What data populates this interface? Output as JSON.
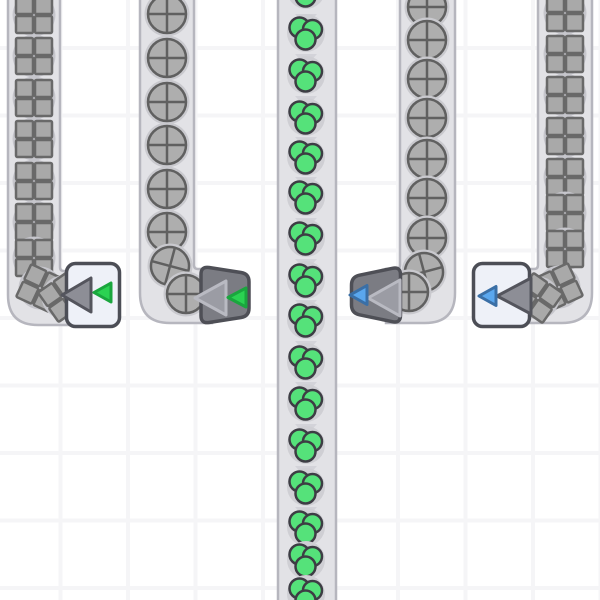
{
  "canvas": {
    "width": 600,
    "height": 600
  },
  "scene": {
    "background": "#ffffff",
    "grid": {
      "size": 67.5,
      "line_width": 4,
      "offset_x": 58.5,
      "offset_y": 46,
      "line_color": "#f5f5f7"
    },
    "belt": {
      "fill": "#e2e2e6",
      "stroke": "#b6b6be",
      "stroke_width": 2.5,
      "chevron_color": "#d3d3d9"
    },
    "items": {
      "square": {
        "fill": "#a9a9a9",
        "stroke": "#696969",
        "halo": "#c6c6cc"
      },
      "circle": {
        "fill": "#aeaeae",
        "stroke": "#606060",
        "halo": "#c9c9ce"
      },
      "berries": {
        "fill": "#55e27a",
        "stroke": "#3d3d44",
        "halo": "#cfcfd4"
      }
    },
    "buildings": {
      "light_body": "#eef1f8",
      "light_border": "#4c4e56",
      "dark_body": "#7b7c83",
      "dark_border": "#4e4f56",
      "arrow_on_light": {
        "fill": "#8d8e96",
        "stroke": "#54555d"
      },
      "arrow_on_dark": {
        "fill": "#9b9ca4",
        "stroke": "#b9bac2"
      },
      "green": {
        "fill": "#2bd252",
        "stroke": "#1aa63e"
      },
      "blue": {
        "fill": "#5aa7ee",
        "stroke": "#3a6fa6"
      }
    }
  },
  "belts": [
    {
      "id": "a",
      "item": "square",
      "cx": 34,
      "track": "M8,-10 L8,295 Q8,325 38,325 L84,325 L84,271 L64,271 Q60,271 60,267 L60,-10 Z",
      "chevrons": [
        14,
        56,
        98,
        140,
        182,
        224,
        254
      ],
      "item_ys": [
        15,
        56,
        98,
        139,
        181,
        222,
        258
      ],
      "curve": [
        {
          "x": 40,
          "y": 288,
          "r": 25
        },
        {
          "x": 63,
          "y": 297,
          "r": 55
        }
      ]
    },
    {
      "id": "b",
      "item": "circle",
      "cx": 167,
      "track": "M140,-10 L140,293 Q140,323 170,323 L212,323 L212,269 L198,269 Q194,269 194,265 L194,-10 Z",
      "chevrons": [
        14,
        58,
        102,
        146,
        190,
        234
      ],
      "item_ys": [
        14,
        58,
        102,
        145,
        189,
        232
      ],
      "curve": [
        {
          "x": 170,
          "y": 266,
          "r": 15
        },
        {
          "x": 186,
          "y": 294,
          "r": 0
        }
      ]
    },
    {
      "id": "c",
      "item": "berries",
      "cx": 306,
      "track": "M278,-10 L278,610 L336,610 L336,-10 Z",
      "chevrons": [
        14,
        54,
        96,
        137,
        177,
        218,
        259,
        300,
        341,
        382,
        424,
        466,
        507,
        544,
        578
      ],
      "item_ys": [
        -10,
        33,
        75,
        117,
        157,
        197,
        238,
        280,
        320,
        362,
        403,
        445,
        487,
        527,
        560,
        594
      ],
      "curve": []
    },
    {
      "id": "d",
      "item": "circle",
      "cx": 427,
      "track": "M400,-10 L400,265 Q400,269 396,269 L386,269 L386,323 L425,323 Q455,323 455,293 L455,-10 Z",
      "chevrons": [
        12,
        54,
        96,
        138,
        180,
        222,
        252
      ],
      "item_ys": [
        7,
        40,
        79,
        118,
        159,
        198,
        238
      ],
      "curve": [
        {
          "x": 424,
          "y": 272,
          "r": -15
        },
        {
          "x": 409,
          "y": 292,
          "r": 0
        }
      ]
    },
    {
      "id": "e",
      "item": "square",
      "cx": 565,
      "track": "M538,-10 L538,265 Q538,269 534,269 L518,269 L518,323 L562,323 Q592,323 592,293 L592,-10 Z",
      "chevrons": [
        14,
        56,
        98,
        140,
        182,
        224,
        252
      ],
      "item_ys": [
        13,
        54,
        95,
        136,
        177,
        213,
        249
      ],
      "curve": [
        {
          "x": 559,
          "y": 287,
          "r": -25
        },
        {
          "x": 538,
          "y": 298,
          "r": -55
        }
      ]
    }
  ],
  "buildings": [
    {
      "name": "building-1",
      "body": "light",
      "rect": {
        "x": 66.5,
        "y": 263.5,
        "w": 53,
        "h": 63,
        "rx": 9
      },
      "big_arrow": [
        [
          62,
          295
        ],
        [
          91,
          278
        ],
        [
          91,
          312
        ]
      ],
      "small_arrow": [
        [
          94,
          292.5
        ],
        [
          111,
          283
        ],
        [
          111,
          302
        ]
      ],
      "small_color": "green"
    },
    {
      "name": "building-2",
      "body": "dark",
      "path": "M209,267.5 L241,272.5 Q249,273.7 249,281.7 L249,308.3 Q249,316.3 241,317.5 L209,322.5 Q201,323.7 201,315.7 L201,274.3 Q201,266.3 209,267.5 Z",
      "big_arrow": [
        [
          195,
          298
        ],
        [
          226,
          281
        ],
        [
          226,
          315
        ]
      ],
      "small_arrow": [
        [
          228,
          297.5
        ],
        [
          246,
          288
        ],
        [
          246,
          307
        ]
      ],
      "small_color": "green"
    },
    {
      "name": "building-3",
      "body": "dark",
      "path": "M359.5,275.2 L392.5,268.3 Q400.5,266.6 400.5,274.8 L400.5,315.2 Q400.5,323.4 392.5,321.7 L359.5,314.8 Q351.5,313.1 351.5,304.9 L351.5,285.1 Q351.5,276.9 359.5,275.2 Z",
      "big_arrow": [
        [
          368,
          298
        ],
        [
          400,
          280
        ],
        [
          400,
          316
        ]
      ],
      "small_arrow": [
        [
          350,
          295
        ],
        [
          367,
          285.5
        ],
        [
          367,
          304.5
        ]
      ],
      "small_color": "blue"
    },
    {
      "name": "building-4",
      "body": "light",
      "rect": {
        "x": 473.5,
        "y": 263.5,
        "w": 56,
        "h": 63,
        "rx": 9
      },
      "big_arrow": [
        [
          497,
          296
        ],
        [
          531,
          278
        ],
        [
          531,
          314
        ]
      ],
      "small_arrow": [
        [
          479,
          296
        ],
        [
          496,
          286.5
        ],
        [
          496,
          305.5
        ]
      ],
      "small_color": "blue"
    }
  ]
}
